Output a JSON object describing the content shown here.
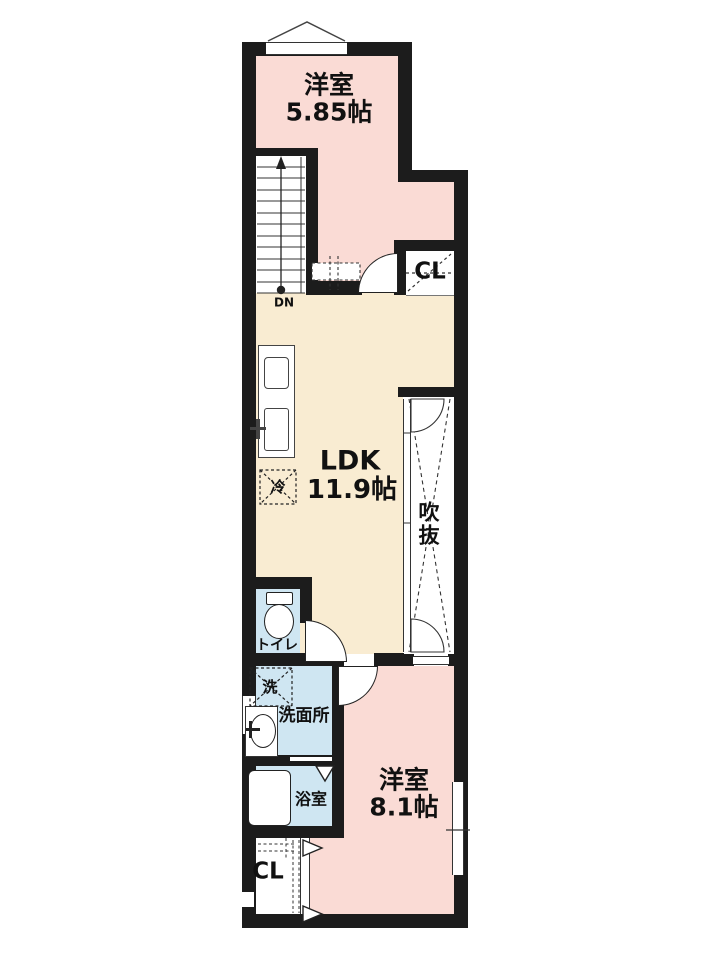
{
  "floorplan": {
    "rooms": {
      "bedroom_top": {
        "name": "洋室",
        "size": "5.85帖"
      },
      "ldk": {
        "name": "LDK",
        "size": "11.9帖"
      },
      "void_space": {
        "chars": [
          "吹",
          "抜"
        ]
      },
      "closet_top": {
        "label": "CL"
      },
      "toilet": {
        "label": "トイレ"
      },
      "laundry": {
        "label": "洗"
      },
      "washroom": {
        "label": "洗面所"
      },
      "bathroom": {
        "label": "浴室"
      },
      "closet_bottom": {
        "label": "CL"
      },
      "bedroom_bottom": {
        "name": "洋室",
        "size": "8.1帖"
      },
      "fridge": {
        "label": "冷"
      },
      "stairs": {
        "label": "DN"
      }
    },
    "colors": {
      "bedroom_pink": "#fadbd5",
      "ldk_cream": "#f9ecd2",
      "wet_area_blue": "#cfe6f2",
      "wall_black": "#1c1c1c",
      "line_dark": "#333333"
    }
  }
}
